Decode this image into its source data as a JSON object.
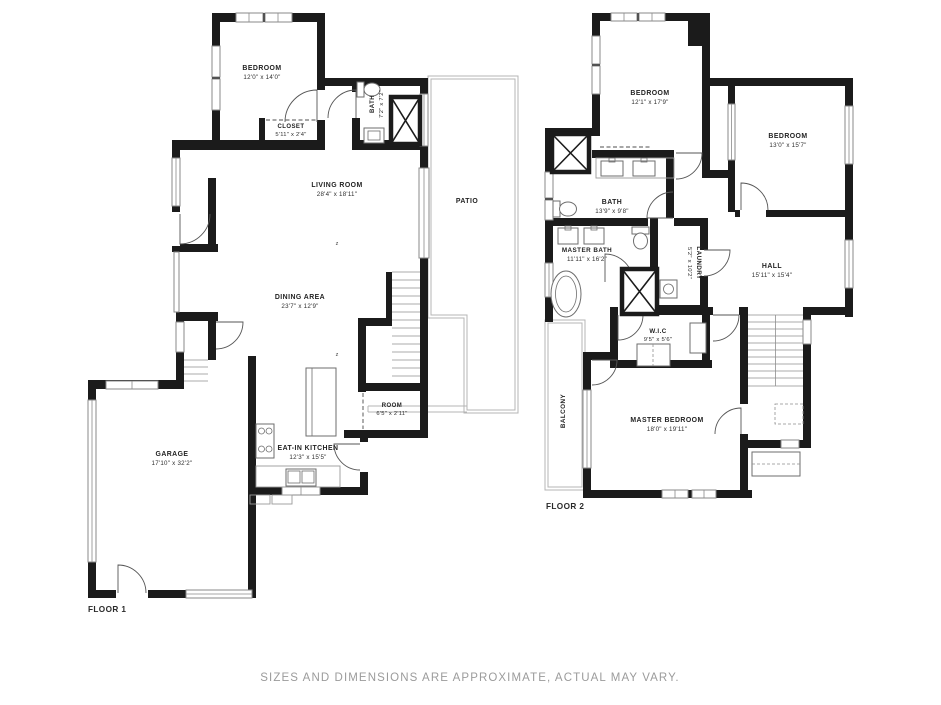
{
  "caption": "SIZES AND DIMENSIONS ARE APPROXIMATE, ACTUAL MAY VARY.",
  "floor1": {
    "label": "FLOOR 1",
    "markers": {
      "z": "z"
    },
    "rooms": {
      "bedroom": {
        "name": "BEDROOM",
        "dims": "12'0\" x 14'0\""
      },
      "closet": {
        "name": "CLOSET",
        "dims": "5'11\" x 2'4\""
      },
      "bath": {
        "name": "BATH",
        "dims": "7'2\" x 7'2\""
      },
      "living_room": {
        "name": "LIVING ROOM",
        "dims": "28'4\" x 18'11\""
      },
      "patio": {
        "name": "PATIO",
        "dims": ""
      },
      "dining_area": {
        "name": "DINING AREA",
        "dims": "23'7\" x 12'9\""
      },
      "room": {
        "name": "ROOM",
        "dims": "6'5\" x 2'11\""
      },
      "eat_in_kitchen": {
        "name": "EAT-IN KITCHEN",
        "dims": "12'3\" x 15'5\""
      },
      "garage": {
        "name": "GARAGE",
        "dims": "17'10\" x 32'2\""
      }
    }
  },
  "floor2": {
    "label": "FLOOR 2",
    "rooms": {
      "bedroom_left": {
        "name": "BEDROOM",
        "dims": "12'1\" x 17'9\""
      },
      "bedroom_right": {
        "name": "BEDROOM",
        "dims": "13'0\" x 15'7\""
      },
      "bath": {
        "name": "BATH",
        "dims": "13'9\" x 9'8\""
      },
      "master_bath": {
        "name": "MASTER BATH",
        "dims": "11'11\" x 16'2\""
      },
      "laundry": {
        "name": "LAUNDRY",
        "dims": "5'2\" x 10'2\""
      },
      "hall": {
        "name": "HALL",
        "dims": "15'11\" x 15'4\""
      },
      "wic": {
        "name": "W.I.C",
        "dims": "9'5\" x 5'6\""
      },
      "balcony": {
        "name": "BALCONY",
        "dims": ""
      },
      "master_bedroom": {
        "name": "MASTER BEDROOM",
        "dims": "18'0\" x 19'11\""
      }
    }
  }
}
